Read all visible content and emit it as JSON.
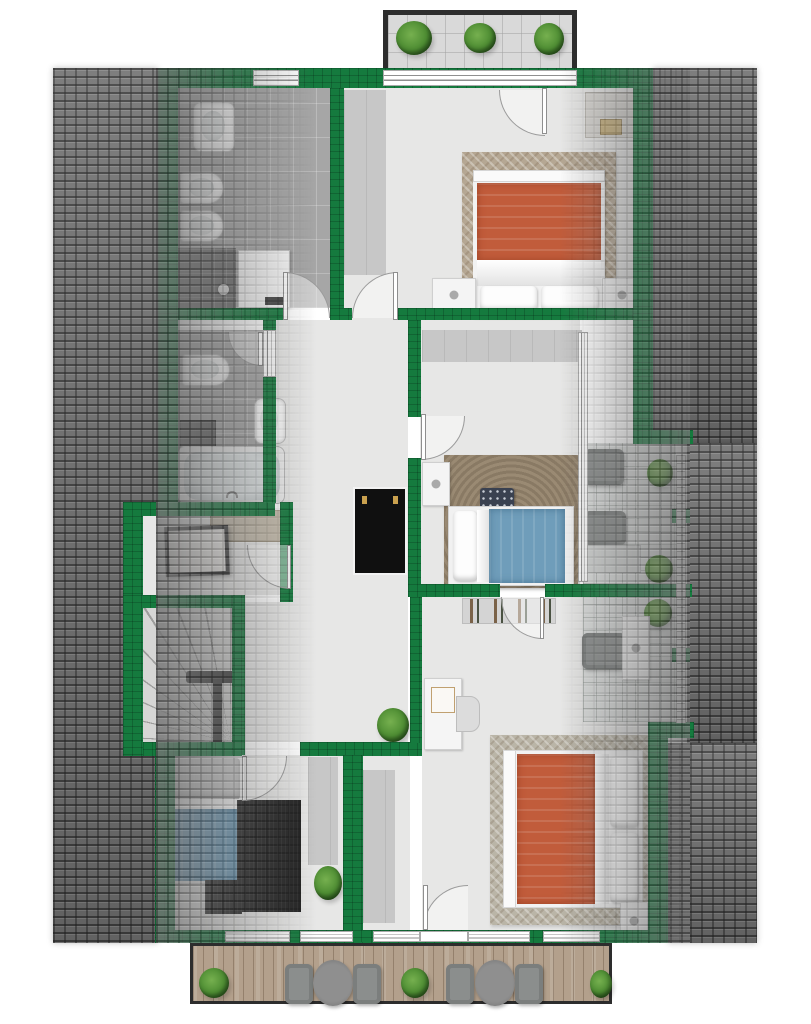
{
  "meta": {
    "type": "floor-plan",
    "description": "3D-style rendered upper-floor apartment plan, no text labels visible",
    "visible_text": []
  },
  "colors": {
    "background": "#ffffff",
    "wall_green": "#157a3e",
    "roof_tile": "#747474",
    "floor": "#e7e7e6",
    "bath_tile": "#a6a6a6",
    "shower_tile": "#6b6b6b",
    "terrace_tile": "#dcdedd",
    "deck_wood": "#b3a08c",
    "balcony_border": "#2d2d2d",
    "bed_orange": "#c15c3b",
    "bed_blue": "#6f9dba",
    "rug_beige": "#b5a793",
    "rug_brown": "#9a8a73",
    "rug_black": "#222222",
    "plant_green": "#4e8d33",
    "furniture_white": "#f4f4f4",
    "wardrobe_gray": "#c7c7c7",
    "handrail_dark": "#3a3a3a",
    "cabinet_black": "#101010",
    "knob_gold": "#caa14e"
  },
  "floorplan": {
    "rooms": [
      {
        "name": "bathroom-large",
        "features": [
          "sink",
          "toilet",
          "bidet",
          "shower",
          "boiler",
          "tiled-floor",
          "window"
        ]
      },
      {
        "name": "bedroom-top-right",
        "features": [
          "double-bed-orange",
          "herringbone-rug",
          "nightstand-left",
          "nightstand-right",
          "wardrobe-strip",
          "dressing-table",
          "balcony-door"
        ]
      },
      {
        "name": "bathroom-small",
        "features": [
          "toilet",
          "sink",
          "bathtub",
          "bath-mat"
        ]
      },
      {
        "name": "storage-room",
        "features": [
          "picture-frame",
          "sideboard"
        ]
      },
      {
        "name": "staircase",
        "features": [
          "winder-stairs",
          "handrail"
        ]
      },
      {
        "name": "hallway",
        "features": [
          "black-cabinet",
          "plant"
        ]
      },
      {
        "name": "bedroom-middle",
        "features": [
          "single-bed-blue",
          "shag-rug",
          "nightstand",
          "dark-cushion",
          "wardrobe-strip",
          "terrace-window"
        ]
      },
      {
        "name": "bedroom-bottom-left",
        "features": [
          "single-bed-blue",
          "black-rug",
          "wardrobe-strip",
          "plant",
          "windows-to-deck"
        ]
      },
      {
        "name": "bedroom-bottom-right",
        "features": [
          "double-bed-orange",
          "herringbone-rug",
          "desk",
          "chair",
          "clothes-rack",
          "wardrobe-strip",
          "nightstand",
          "deck-door"
        ]
      },
      {
        "name": "terrace-upper",
        "features": [
          "sofa",
          "armchair",
          "coffee-table",
          "plants",
          "railing"
        ]
      },
      {
        "name": "terrace-lower",
        "features": [
          "armchair",
          "white-cabinet",
          "plants",
          "railing"
        ]
      },
      {
        "name": "balcony-top",
        "features": [
          "three-planters",
          "tiled-floor",
          "sliding-window"
        ]
      },
      {
        "name": "deck-bottom",
        "features": [
          "bistro-set-1",
          "bistro-set-2",
          "three-planters",
          "wood-planks"
        ]
      }
    ]
  }
}
